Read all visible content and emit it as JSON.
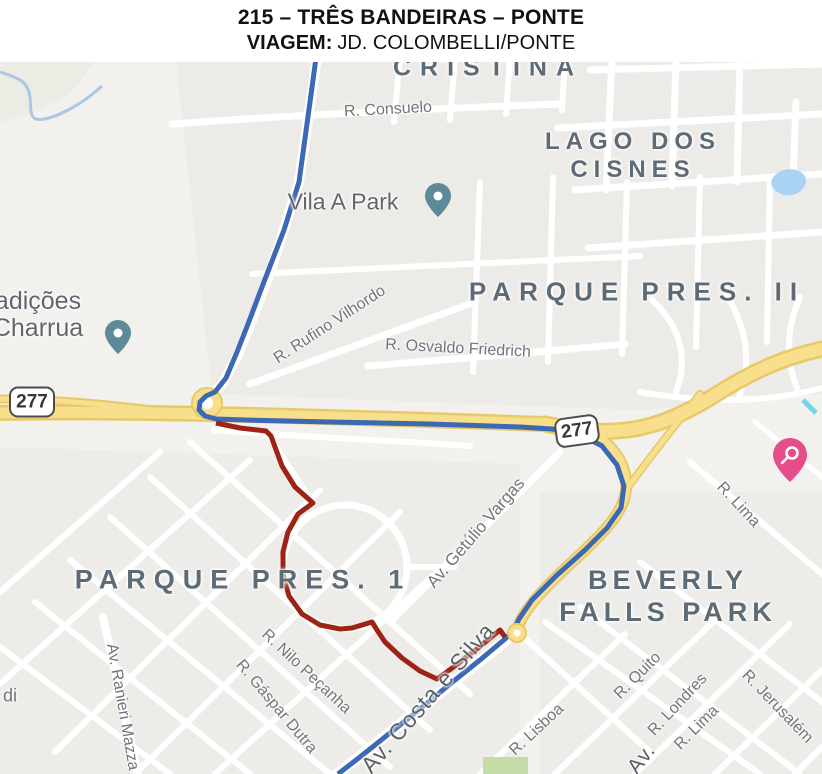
{
  "header": {
    "title_line": "215 – TRÊS BANDEIRAS – PONTE",
    "viagem_label": "VIAGEM:",
    "viagem_value": "JD. COLOMBELLI/PONTE"
  },
  "map": {
    "area_labels": [
      {
        "text": "CRISTINA"
      },
      {
        "line1": "LAGO DOS",
        "line2": "CISNES"
      },
      {
        "text": "PARQUE PRES. II"
      },
      {
        "text": "PARQUE PRES. 1"
      },
      {
        "line1": "BEVERLY",
        "line2": "FALLS PARK"
      }
    ],
    "street_labels": [
      {
        "text": "R. Consuelo"
      },
      {
        "text": "R. Rufino Vilhordo"
      },
      {
        "text": "R. Osvaldo Friedrich"
      },
      {
        "text": "Av. Getúlio Vargas"
      },
      {
        "text": "Av. Costa e Silva"
      },
      {
        "text": "R. Nilo Peçanha"
      },
      {
        "text": "R. Gáspar Dutra"
      },
      {
        "text": "Av. Ranieri Mazza"
      },
      {
        "text": "R. Lima"
      },
      {
        "text": "R. Quito"
      },
      {
        "text": "R. Londres"
      },
      {
        "text": "R. Lima"
      },
      {
        "text": "R. Jerusalém"
      },
      {
        "text": "R. Lisboa"
      },
      {
        "text": "di"
      },
      {
        "text": "Av."
      }
    ],
    "poi_labels": [
      {
        "text": "Vila A Park"
      },
      {
        "line1": "adições",
        "line2": "Charrua"
      }
    ],
    "shields": [
      {
        "text": "277"
      },
      {
        "text": "277"
      }
    ],
    "colors": {
      "route_blue": "#3c68b4",
      "route_red": "#9c2315",
      "highway_fill": "#f7df8b",
      "highway_casing": "#e8c969",
      "pin_teal": "#5d8a99",
      "pin_pink": "#e74d8a",
      "water": "#a9d2f3"
    }
  }
}
